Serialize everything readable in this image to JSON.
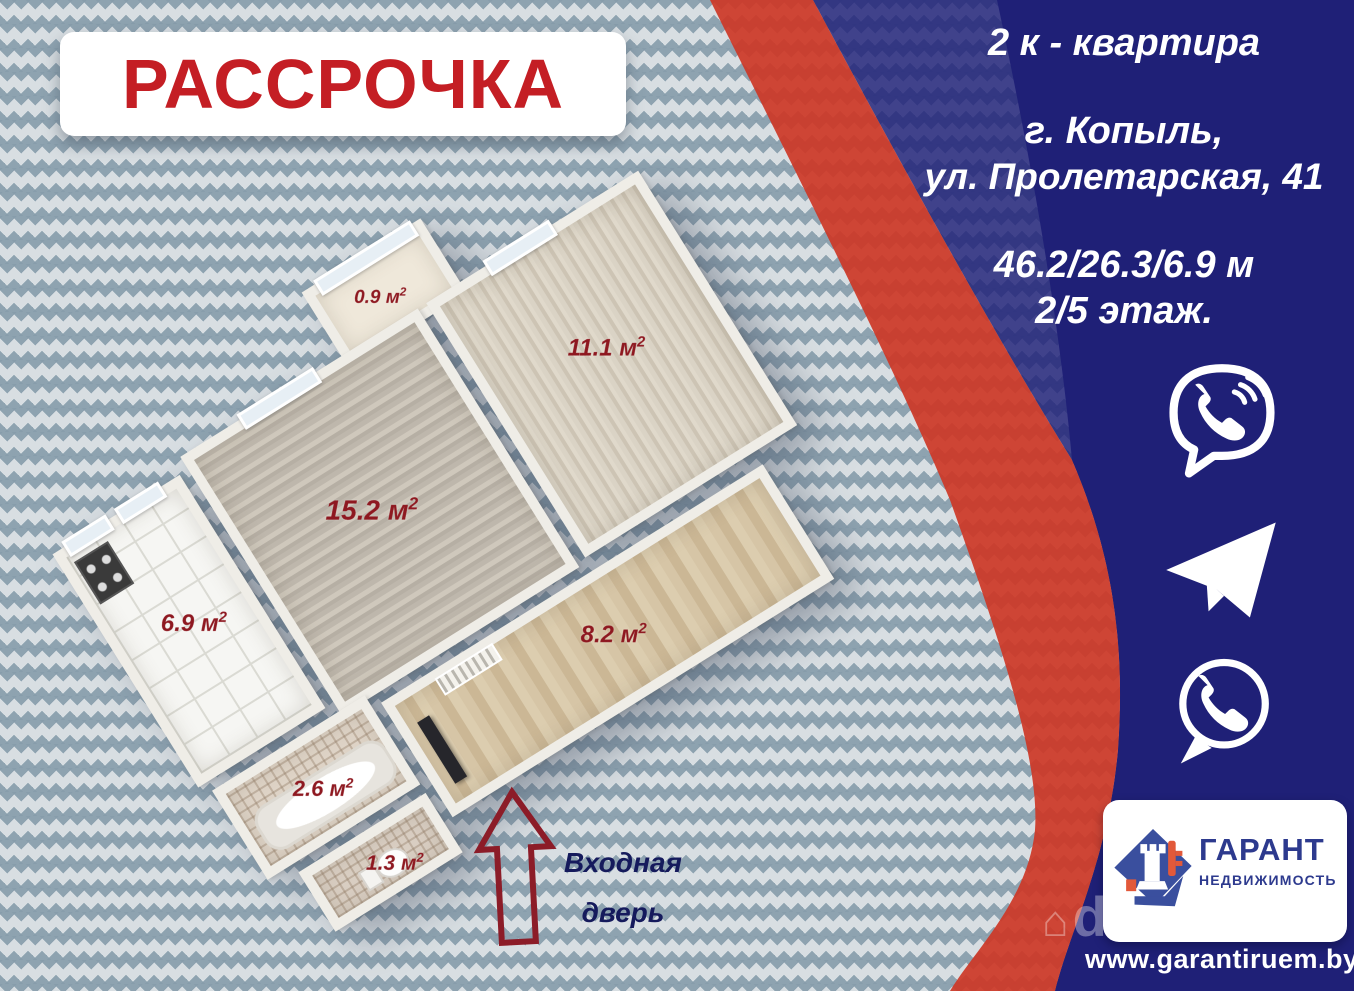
{
  "promo": {
    "label": "РАССРОЧКА"
  },
  "listing": {
    "type": "2 к - квартира",
    "city": "г. Копыль,",
    "street": "ул. Пролетарская, 41",
    "dimensions": "46.2/26.3/6.9 м",
    "floor": "2/5 этаж."
  },
  "floorplan": {
    "rooms": {
      "balcony": {
        "value": "0.9 м",
        "sup": "2"
      },
      "living": {
        "value": "15.2 м",
        "sup": "2"
      },
      "bedroom": {
        "value": "11.1 м",
        "sup": "2"
      },
      "kitchen": {
        "value": "6.9 м",
        "sup": "2"
      },
      "bathroom": {
        "value": "2.6 м",
        "sup": "2"
      },
      "hall": {
        "value": "8.2 м",
        "sup": "2"
      },
      "wc": {
        "value": "1.3 м",
        "sup": "2"
      }
    },
    "entrance": {
      "line1": "Входная",
      "line2": "дверь"
    }
  },
  "contacts": {
    "icons": [
      "viber-icon",
      "telegram-icon",
      "whatsapp-icon"
    ]
  },
  "agency": {
    "name": "ГАРАНТ",
    "subtitle": "НЕДВИЖИМОСТЬ",
    "website": "www.garantiruem.by"
  },
  "watermark": {
    "house": "⌂",
    "text": "dominfo"
  },
  "colors": {
    "promo_red": "#c41e24",
    "ribbon_red": "#cd3726",
    "navy": "#1f2077",
    "area_label_red": "#8e1820",
    "entrance_navy": "#151a5c",
    "pattern_base": "#d8dee2",
    "pattern_diamond": "#869cab"
  }
}
